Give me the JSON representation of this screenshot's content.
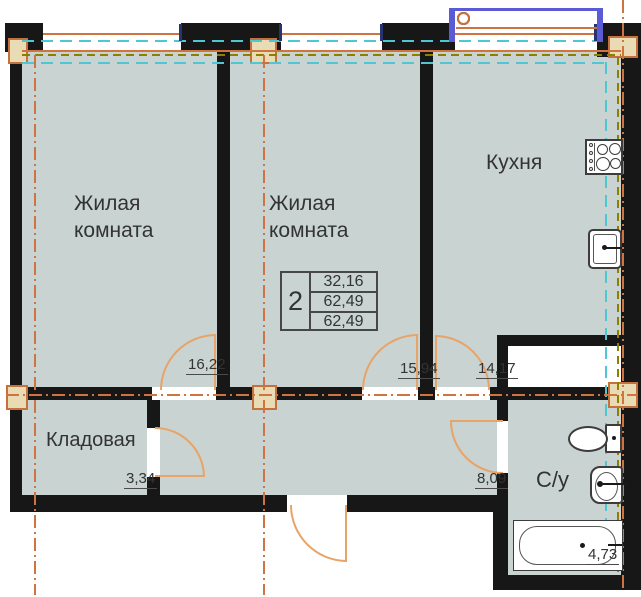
{
  "colors": {
    "wall": "#171717",
    "room_fill": "#c9d3d1",
    "column_fill": "#e9dcb5",
    "column_border": "#c4713d",
    "window": "#4ec7d2",
    "door": "#e8a368",
    "axis": "#cf7440",
    "insulation": "#8b8000",
    "balcony": "#5b5bd6",
    "fixture": "#3c3c3c",
    "text": "#333333"
  },
  "rooms": {
    "living1": {
      "name": [
        "Жилая",
        "комната"
      ],
      "area": "16,22"
    },
    "living2": {
      "name": [
        "Жилая",
        "комната"
      ],
      "area": "15,94"
    },
    "kitchen": {
      "name": "Кухня",
      "area": "14,17"
    },
    "storage": {
      "name": "Кладовая",
      "area": "3,34"
    },
    "hallway": {
      "area": "8,09"
    },
    "bathroom": {
      "name": "С/у",
      "area": "4,73"
    }
  },
  "stamp": {
    "rooms_count": "2",
    "living_area": "32,16",
    "total_area": "62,49",
    "overall_area": "62,49"
  },
  "fixtures": [
    "stove",
    "kitchen-sink",
    "toilet",
    "wash-basin",
    "bathtub"
  ]
}
